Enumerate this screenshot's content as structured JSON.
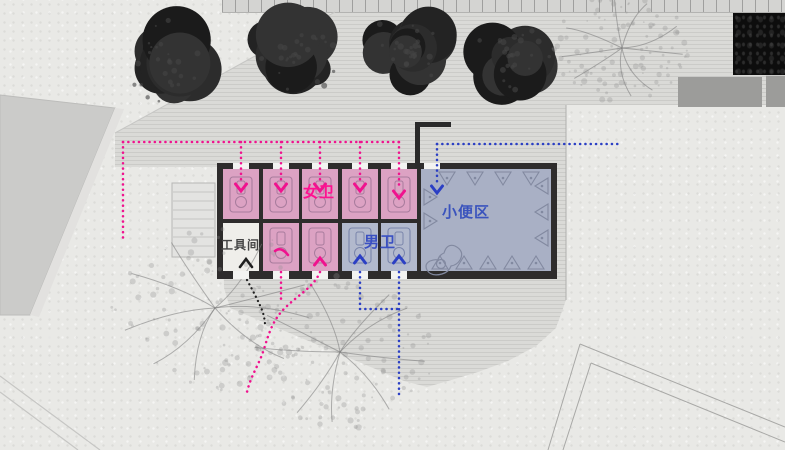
{
  "plan": {
    "rooms": {
      "female_zone": {
        "label": "女卫"
      },
      "male_zone": {
        "label": "男卫"
      },
      "urinal_zone": {
        "label": "小便区"
      },
      "tool_room": {
        "label": "工具间"
      }
    },
    "stall_counts": {
      "female_top_row": 5,
      "female_bottom_row": 2,
      "male_bottom_row": 2,
      "urinal_room": 1,
      "tool_room": 1
    },
    "flow_colors": {
      "female": "#f0128e",
      "male": "#2b3fc4",
      "service": "#1f1f1f"
    },
    "room_fills": {
      "female": "#dca2c3",
      "male": "#b2b9cd",
      "urinal": "#a9b0c5",
      "tool": "#efeeea",
      "wall": "#2e2c2c"
    },
    "label_colors": {
      "female": "#ff1090",
      "male": "#3a50c2",
      "urinal": "#3a53bd",
      "tool": "#454545"
    }
  }
}
